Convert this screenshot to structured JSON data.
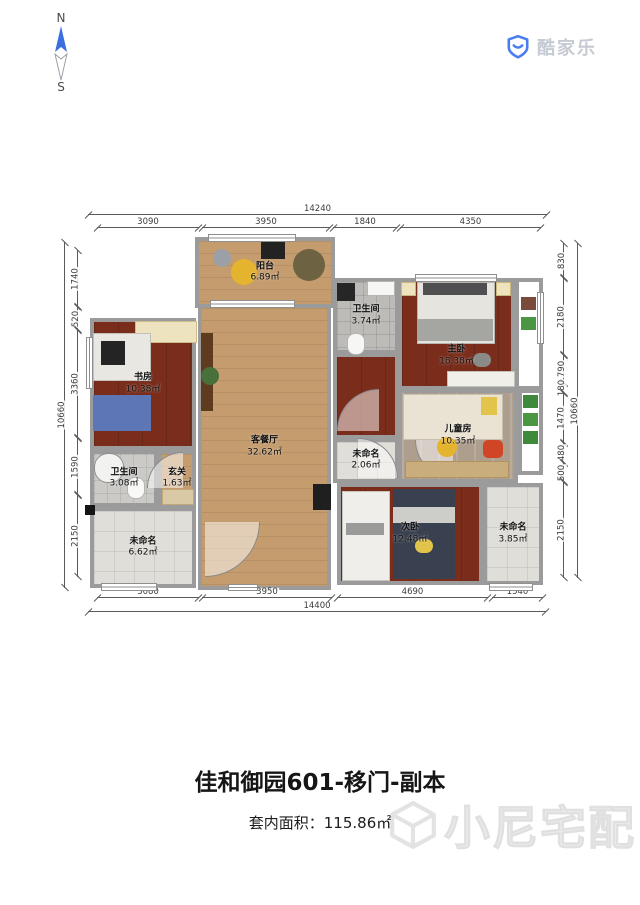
{
  "compass": {
    "north": "N",
    "south": "S"
  },
  "logo": {
    "brand": "酷家乐"
  },
  "footer": {
    "title": "佳和御园601-移门-副本",
    "area_prefix": "套内面积：",
    "area_value": "115.86㎡",
    "watermark": "小尼宅配"
  },
  "colors": {
    "wall": "#9b9b9b",
    "wood_floor": "#c59c6e",
    "dark_floor": "#7b2d1c",
    "kids_floor": "#ae9e8e",
    "tile_floor": "#e0ded8",
    "logo_blue": "#4a7df0",
    "compass_blue": "#3b6fe0"
  },
  "rooms": [
    {
      "id": "balcony",
      "name": "阳台",
      "area": "6.89㎡",
      "rect": [
        110,
        0,
        140,
        71
      ],
      "floor": "wood"
    },
    {
      "id": "living",
      "name": "客餐厅",
      "area": "32.62㎡",
      "rect": [
        113,
        67,
        133,
        286
      ],
      "floor": "wood"
    },
    {
      "id": "bath-top",
      "name": "卫生间",
      "area": "3.74㎡",
      "rect": [
        248,
        41,
        66,
        76
      ],
      "floor": "bath"
    },
    {
      "id": "master",
      "name": "主卧",
      "area": "18.38㎡",
      "rect": [
        313,
        41,
        117,
        112
      ],
      "floor": "dark",
      "label_dy": 22
    },
    {
      "id": "master-hall",
      "name": "",
      "area": "",
      "rect": [
        248,
        116,
        66,
        86
      ],
      "floor": "dark"
    },
    {
      "id": "kids",
      "name": "儿童房",
      "area": "10.35㎡",
      "rect": [
        313,
        152,
        120,
        94
      ],
      "floor": "kids"
    },
    {
      "id": "hall",
      "name": "未命名",
      "area": "2.06㎡",
      "rect": [
        248,
        201,
        66,
        45
      ],
      "floor": "tile"
    },
    {
      "id": "study",
      "name": "书房",
      "area": "10.38㎡",
      "rect": [
        5,
        81,
        106,
        132
      ],
      "floor": "dark"
    },
    {
      "id": "bath-left",
      "name": "卫生间",
      "area": "3.08㎡",
      "rect": [
        5,
        213,
        68,
        57
      ],
      "floor": "bath2"
    },
    {
      "id": "foyer",
      "name": "玄关",
      "area": "1.63㎡",
      "rect": [
        73,
        213,
        38,
        57
      ],
      "floor": "wood"
    },
    {
      "id": "unnamed-bl",
      "name": "未命名",
      "area": "6.62㎡",
      "rect": [
        5,
        270,
        106,
        81
      ],
      "floor": "tile"
    },
    {
      "id": "second",
      "name": "次卧",
      "area": "12.48㎡",
      "rect": [
        252,
        246,
        146,
        102
      ],
      "floor": "dark"
    },
    {
      "id": "unnamed-br",
      "name": "未命名",
      "area": "3.85㎡",
      "rect": [
        398,
        246,
        60,
        102
      ],
      "floor": "tile"
    },
    {
      "id": "strip-master",
      "name": "",
      "area": "",
      "rect": [
        430,
        41,
        28,
        112
      ],
      "floor": "white"
    },
    {
      "id": "strip-kids",
      "name": "",
      "area": "",
      "rect": [
        433,
        152,
        25,
        86
      ],
      "floor": "white"
    }
  ],
  "furniture": [
    {
      "id": "bed-master",
      "rect": [
        332,
        45,
        76,
        60
      ],
      "color": "#e6e4df",
      "border": "#b8b5ae"
    },
    {
      "id": "pillows-master",
      "rect": [
        338,
        46,
        64,
        12
      ],
      "color": "#4f4f52"
    },
    {
      "id": "blanket-master",
      "rect": [
        332,
        82,
        76,
        22
      ],
      "color": "#a5a5a2"
    },
    {
      "id": "nightstand-left",
      "rect": [
        316,
        45,
        13,
        12
      ],
      "color": "#efe3bd",
      "border": "#c9b87e"
    },
    {
      "id": "nightstand-right",
      "rect": [
        411,
        45,
        13,
        12
      ],
      "color": "#efe3bd",
      "border": "#c9b87e"
    },
    {
      "id": "dresser-master",
      "rect": [
        362,
        134,
        66,
        14
      ],
      "color": "#f1efe9",
      "border": "#c4c1b8"
    },
    {
      "id": "chair-master",
      "rect": [
        388,
        116,
        18,
        14
      ],
      "color": "#8a8a88",
      "radius": 7
    },
    {
      "id": "bed-kids",
      "rect": [
        318,
        157,
        98,
        44
      ],
      "color": "#eae3d3",
      "border": "#c8c0ac"
    },
    {
      "id": "pillow-kids",
      "rect": [
        396,
        160,
        16,
        18
      ],
      "color": "#e3c44a"
    },
    {
      "id": "chair-red-kids",
      "rect": [
        398,
        203,
        20,
        18
      ],
      "color": "#cf4526",
      "radius": 5
    },
    {
      "id": "stool-yellow-kids",
      "rect": [
        352,
        200,
        20,
        20
      ],
      "color": "#e5b42e",
      "radius": 10
    },
    {
      "id": "desk-kids",
      "rect": [
        320,
        224,
        102,
        15
      ],
      "color": "#c9ad7c",
      "border": "#b3935d"
    },
    {
      "id": "desks-second",
      "rect": [
        257,
        254,
        46,
        88
      ],
      "color": "#efeeea",
      "border": "#c6c4bd"
    },
    {
      "id": "chairs-second",
      "rect": [
        261,
        286,
        38,
        12
      ],
      "color": "#9a9a98"
    },
    {
      "id": "bed-second",
      "rect": [
        308,
        252,
        62,
        90
      ],
      "color": "#39404f"
    },
    {
      "id": "sheet-second",
      "rect": [
        308,
        270,
        62,
        16
      ],
      "color": "#cdcdca"
    },
    {
      "id": "pillow-second",
      "rect": [
        330,
        302,
        18,
        14
      ],
      "color": "#e3c44a",
      "radius": 7
    },
    {
      "id": "cabinet-study",
      "rect": [
        50,
        84,
        60,
        20
      ],
      "color": "#eee3bf",
      "border": "#cdbd8a"
    },
    {
      "id": "desk-study",
      "rect": [
        8,
        96,
        56,
        46
      ],
      "color": "#e9e7e1",
      "border": "#c2c0b9"
    },
    {
      "id": "monitor-study",
      "rect": [
        16,
        104,
        24,
        24
      ],
      "color": "#242424"
    },
    {
      "id": "sofa-study",
      "rect": [
        8,
        158,
        58,
        36
      ],
      "color": "#5d76b5"
    },
    {
      "id": "tv-cabinet-living",
      "rect": [
        116,
        96,
        12,
        78
      ],
      "color": "#5e3a1f"
    },
    {
      "id": "plant-living",
      "rect": [
        116,
        130,
        18,
        18
      ],
      "color": "#47703b",
      "radius": 9
    },
    {
      "id": "cabinet-living-right",
      "rect": [
        228,
        247,
        18,
        26
      ],
      "color": "#1f1f1f"
    },
    {
      "id": "chair-balcony",
      "rect": [
        128,
        12,
        18,
        18
      ],
      "color": "#9aa0a6",
      "radius": 9
    },
    {
      "id": "table-balcony",
      "rect": [
        146,
        22,
        26,
        26
      ],
      "color": "#e5b42e",
      "radius": 13
    },
    {
      "id": "tv-balcony",
      "rect": [
        176,
        4,
        24,
        18
      ],
      "color": "#222222"
    },
    {
      "id": "plant-balcony",
      "rect": [
        208,
        12,
        32,
        32
      ],
      "color": "#6d6242",
      "radius": 16
    },
    {
      "id": "washer-bath-top",
      "rect": [
        252,
        46,
        18,
        18
      ],
      "color": "#262626"
    },
    {
      "id": "sink-bath-top",
      "rect": [
        282,
        44,
        26,
        13
      ],
      "color": "#f6f6f4",
      "border": "#b5b5b2"
    },
    {
      "id": "toilet-bath-top",
      "rect": [
        262,
        96,
        16,
        20
      ],
      "color": "#f6f6f4",
      "border": "#b5b5b2",
      "radius": 8
    },
    {
      "id": "shower-bath-left",
      "rect": [
        9,
        216,
        28,
        28
      ],
      "color": "#f2f2f0",
      "border": "#8e8e8c",
      "radius": 14
    },
    {
      "id": "toilet-bath-left",
      "rect": [
        42,
        240,
        16,
        20
      ],
      "color": "#f8f8f6",
      "border": "#b5b5b2",
      "radius": 8
    },
    {
      "id": "cabinet-foyer",
      "rect": [
        77,
        252,
        30,
        14
      ],
      "color": "#d9c9a4",
      "border": "#bfa877"
    },
    {
      "id": "plant-strip-1",
      "rect": [
        438,
        158,
        15,
        13
      ],
      "color": "#3f8a3a"
    },
    {
      "id": "plant-strip-2",
      "rect": [
        438,
        176,
        15,
        13
      ],
      "color": "#4a9642"
    },
    {
      "id": "plant-strip-3",
      "rect": [
        438,
        194,
        15,
        13
      ],
      "color": "#3f8a3a"
    },
    {
      "id": "plant-master-right",
      "rect": [
        436,
        60,
        15,
        13
      ],
      "color": "#7a4a3a"
    },
    {
      "id": "plant-master-right2",
      "rect": [
        436,
        80,
        15,
        13
      ],
      "color": "#4a9642"
    },
    {
      "id": "column-1",
      "rect": [
        0,
        268,
        10,
        10
      ],
      "color": "#141414"
    }
  ],
  "windows": [
    {
      "rect": [
        123,
        -3,
        88,
        8
      ],
      "o": "h"
    },
    {
      "rect": [
        125,
        63,
        85,
        8
      ],
      "o": "h"
    },
    {
      "rect": [
        330,
        37,
        82,
        8
      ],
      "o": "h"
    },
    {
      "rect": [
        452,
        55,
        7,
        52
      ],
      "o": "v"
    },
    {
      "rect": [
        1,
        100,
        7,
        52
      ],
      "o": "v"
    },
    {
      "rect": [
        16,
        346,
        56,
        8
      ],
      "o": "h"
    },
    {
      "rect": [
        404,
        346,
        44,
        8
      ],
      "o": "h"
    },
    {
      "rect": [
        143,
        347,
        30,
        7
      ],
      "o": "h"
    }
  ],
  "arcs": [
    {
      "rect": [
        120,
        285,
        55,
        55
      ],
      "corner": "br"
    },
    {
      "rect": [
        252,
        152,
        42,
        42
      ],
      "corner": "tl"
    },
    {
      "rect": [
        273,
        201,
        40,
        40
      ],
      "corner": "tr"
    },
    {
      "rect": [
        330,
        203,
        38,
        38
      ],
      "corner": "bl"
    },
    {
      "rect": [
        62,
        215,
        36,
        36
      ],
      "corner": "tl"
    }
  ],
  "dimensions": {
    "top": [
      {
        "label": "14240",
        "from": 88,
        "to": 547,
        "offset": 214,
        "overall": true
      },
      {
        "label": "3090",
        "from": 97,
        "to": 199,
        "offset": 227
      },
      {
        "label": "3950",
        "from": 202,
        "to": 330,
        "offset": 227
      },
      {
        "label": "1840",
        "from": 333,
        "to": 397,
        "offset": 227
      },
      {
        "label": "4350",
        "from": 400,
        "to": 541,
        "offset": 227
      }
    ],
    "bottom": [
      {
        "label": "3080",
        "from": 97,
        "to": 199,
        "offset": 597
      },
      {
        "label": "3950",
        "from": 202,
        "to": 332,
        "offset": 597
      },
      {
        "label": "4690",
        "from": 337,
        "to": 488,
        "offset": 597
      },
      {
        "label": "1540",
        "from": 492,
        "to": 543,
        "offset": 597
      },
      {
        "label": "14400",
        "from": 88,
        "to": 546,
        "offset": 611,
        "overall": true
      }
    ],
    "left": [
      {
        "label": "10660",
        "from": 242,
        "to": 588,
        "offset": 64,
        "overall": true
      },
      {
        "label": "1740",
        "from": 250,
        "to": 307,
        "offset": 77
      },
      {
        "label": "520",
        "from": 307,
        "to": 330,
        "offset": 77
      },
      {
        "label": "3360",
        "from": 330,
        "to": 438,
        "offset": 77
      },
      {
        "label": "1590",
        "from": 438,
        "to": 495,
        "offset": 77
      },
      {
        "label": "2150",
        "from": 495,
        "to": 577,
        "offset": 77
      }
    ],
    "right": [
      {
        "label": "830",
        "from": 243,
        "to": 278,
        "offset": 563
      },
      {
        "label": "2180",
        "from": 278,
        "to": 355,
        "offset": 563
      },
      {
        "label": "790",
        "from": 355,
        "to": 383,
        "offset": 563
      },
      {
        "label": "180",
        "from": 383,
        "to": 393,
        "offset": 563
      },
      {
        "label": "1470",
        "from": 393,
        "to": 443,
        "offset": 563
      },
      {
        "label": "480",
        "from": 443,
        "to": 463,
        "offset": 563
      },
      {
        "label": "500",
        "from": 463,
        "to": 482,
        "offset": 563
      },
      {
        "label": "2150",
        "from": 482,
        "to": 578,
        "offset": 563
      },
      {
        "label": "10660",
        "from": 243,
        "to": 578,
        "offset": 577,
        "overall": true
      }
    ]
  }
}
